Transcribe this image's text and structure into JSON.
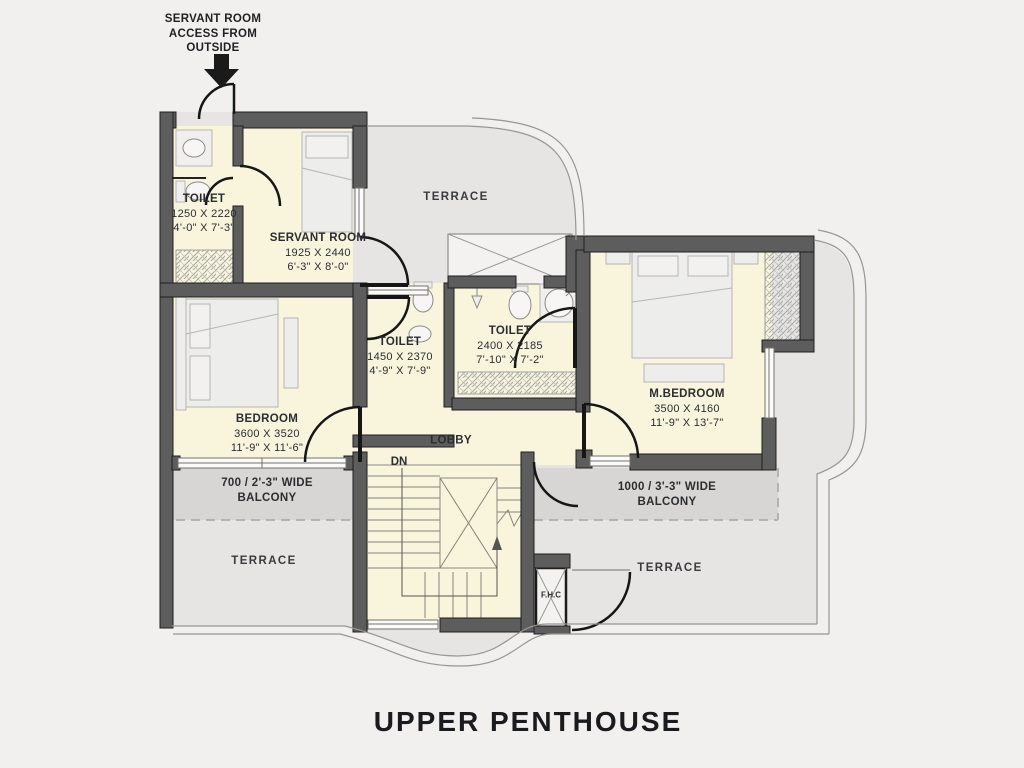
{
  "title": "UPPER PENTHOUSE",
  "annotation": {
    "line1": "SERVANT ROOM",
    "line2": "ACCESS FROM",
    "line3": "OUTSIDE"
  },
  "rooms": {
    "toilet_servant": {
      "name": "TOILET",
      "mm": "1250 X 2220",
      "ft": "4'-0\" X 7'-3\""
    },
    "servant_room": {
      "name": "SERVANT ROOM",
      "mm": "1925 X 2440",
      "ft": "6'-3\" X 8'-0\""
    },
    "toilet_common": {
      "name": "TOILET",
      "mm": "1450 X 2370",
      "ft": "4'-9\" X 7'-9\""
    },
    "toilet_master": {
      "name": "TOILET",
      "mm": "2400 X 2185",
      "ft": "7'-10\" X 7'-2\""
    },
    "bedroom": {
      "name": "BEDROOM",
      "mm": "3600 X 3520",
      "ft": "11'-9\" X 11'-6\""
    },
    "master_bedroom": {
      "name": "M.BEDROOM",
      "mm": "3500 X 4160",
      "ft": "11'-9\" X 13'-7\""
    },
    "lobby": {
      "name": "LOBBY"
    },
    "fhc": {
      "name": "F.H.C"
    }
  },
  "areas": {
    "terrace_top": "TERRACE",
    "terrace_bottom_left": "TERRACE",
    "terrace_bottom_right": "TERRACE",
    "balcony_left_line1": "700 / 2'-3\" WIDE",
    "balcony_left_line2": "BALCONY",
    "balcony_right_line1": "1000 / 3'-3\" WIDE",
    "balcony_right_line2": "BALCONY",
    "stairs_down": "DN"
  },
  "colors": {
    "page_background": "#f1f0ee",
    "wall": "#5d5d5d",
    "wall_edge": "#1f1f1f",
    "room_fill": "#f8f5dc",
    "terrace_fill": "#e6e5e3",
    "balcony_fill": "#d7d6d4",
    "furniture_fill": "#ededeb",
    "text": "#2c2d31"
  }
}
